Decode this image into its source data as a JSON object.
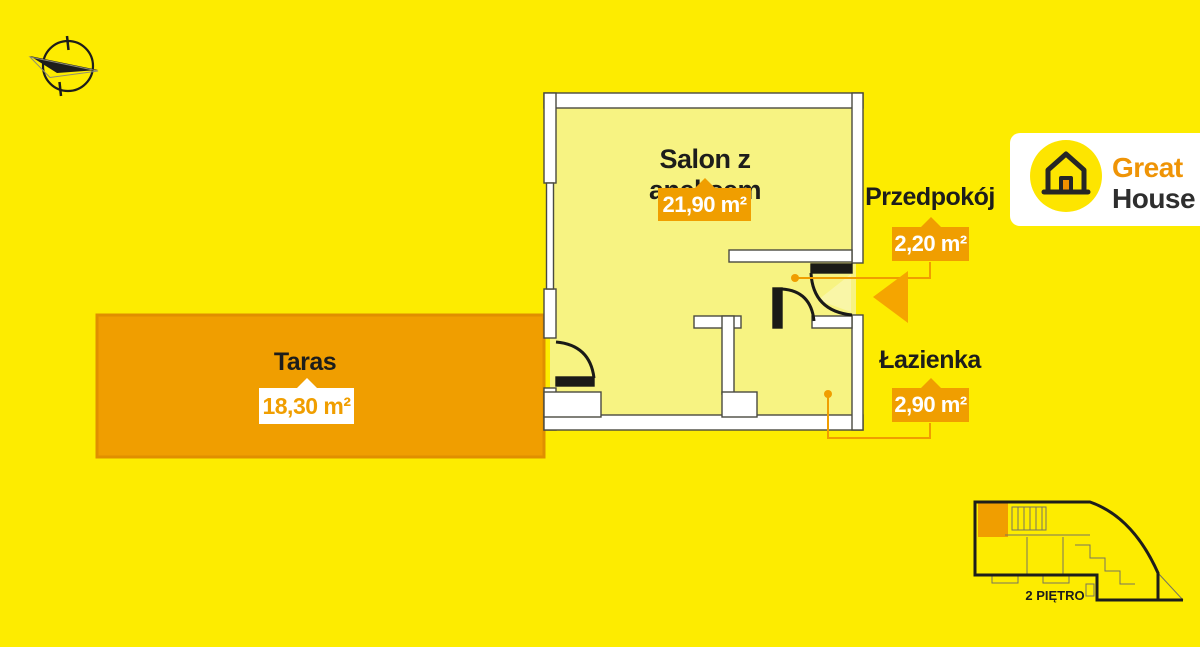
{
  "colors": {
    "background": "#fdec00",
    "floor": "#f7f382",
    "wall_fill": "#ffffff",
    "wall_outline": "#4a4a40",
    "accent_orange": "#f09e00",
    "terrace_border": "#e08f00",
    "label_black": "#1d1d1b",
    "logo_great_orange": "#ef9406",
    "logo_house_black": "#2e2e2e"
  },
  "rooms": [
    {
      "id": "salon",
      "label": "Salon z aneksem",
      "area": "21,90 m²"
    },
    {
      "id": "przedpokoj",
      "label": "Przedpokój",
      "area": "2,20 m²"
    },
    {
      "id": "lazienka",
      "label": "Łazienka",
      "area": "2,90 m²"
    },
    {
      "id": "taras",
      "label": "Taras",
      "area": "18,30 m²"
    }
  ],
  "logo": {
    "brand_top": "Great",
    "brand_bottom": "House"
  },
  "minimap": {
    "floor_label": "2 PIĘTRO"
  }
}
